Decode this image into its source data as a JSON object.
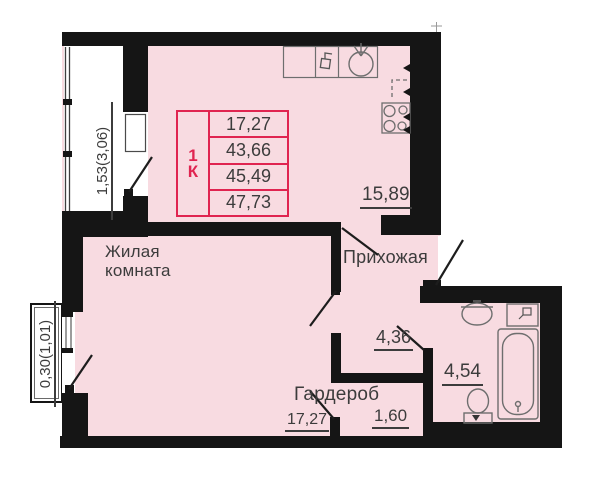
{
  "info_box": {
    "type_digit": "1",
    "type_letter": "К",
    "areas": [
      "17,27",
      "43,66",
      "45,49",
      "47,73"
    ]
  },
  "rooms": {
    "living": {
      "name": "Жилая комната",
      "area": "17,27"
    },
    "kitchen": {
      "area": "15,89"
    },
    "hallway": {
      "name": "Прихожая",
      "area": "4,36"
    },
    "wardrobe": {
      "name": "Гардероб",
      "area": "1,60"
    },
    "bathroom": {
      "area": "4,54"
    }
  },
  "balconies": {
    "left": {
      "dimension": "1,53(3,06)"
    },
    "bottom": {
      "dimension": "0,30(1,01)"
    }
  },
  "fixtures": {
    "kitchen": [
      "counter",
      "faucet",
      "round-sink",
      "stove",
      "fridge-dashed"
    ],
    "bathroom": [
      "sink",
      "washing-machine",
      "bathtub",
      "toilet"
    ]
  },
  "colors": {
    "room_fill": "#f8dbe1",
    "wall": "#151515",
    "accent": "#e02450",
    "text": "#3c3c3c",
    "fixture": "#6e6e6e"
  }
}
